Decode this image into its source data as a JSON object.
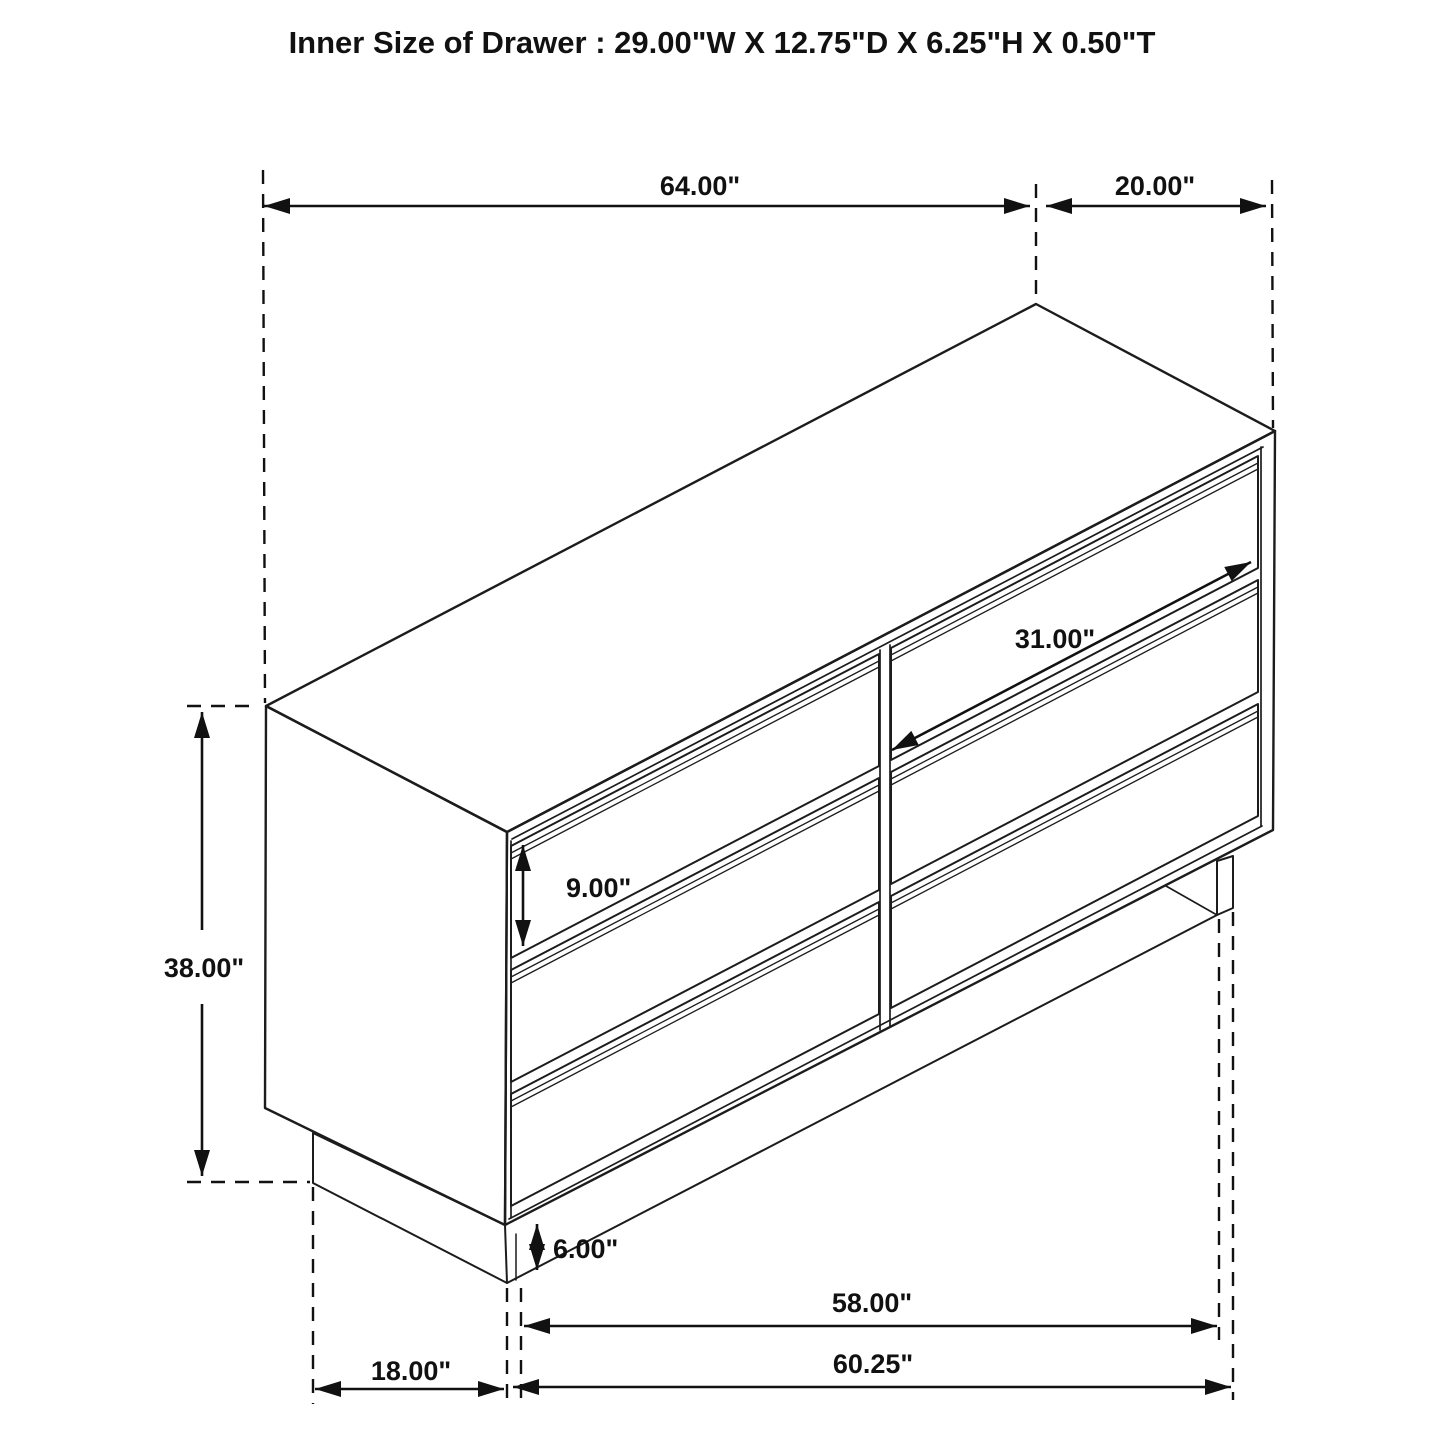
{
  "title": "Inner Size of Drawer : 29.00\"W X 12.75\"D X 6.25\"H X 0.50\"T",
  "dimensions": {
    "top_width": "64.00\"",
    "side_depth": "20.00\"",
    "height": "38.00\"",
    "drawer_width": "31.00\"",
    "drawer_front_height": "9.00\"",
    "base_clearance": "6.00\"",
    "base_width": "58.00\"",
    "overall_base_width": "60.25\"",
    "side_base_depth": "18.00\""
  },
  "colors": {
    "line": "#1c1c1c",
    "dimension": "#111111",
    "background": "#ffffff"
  }
}
